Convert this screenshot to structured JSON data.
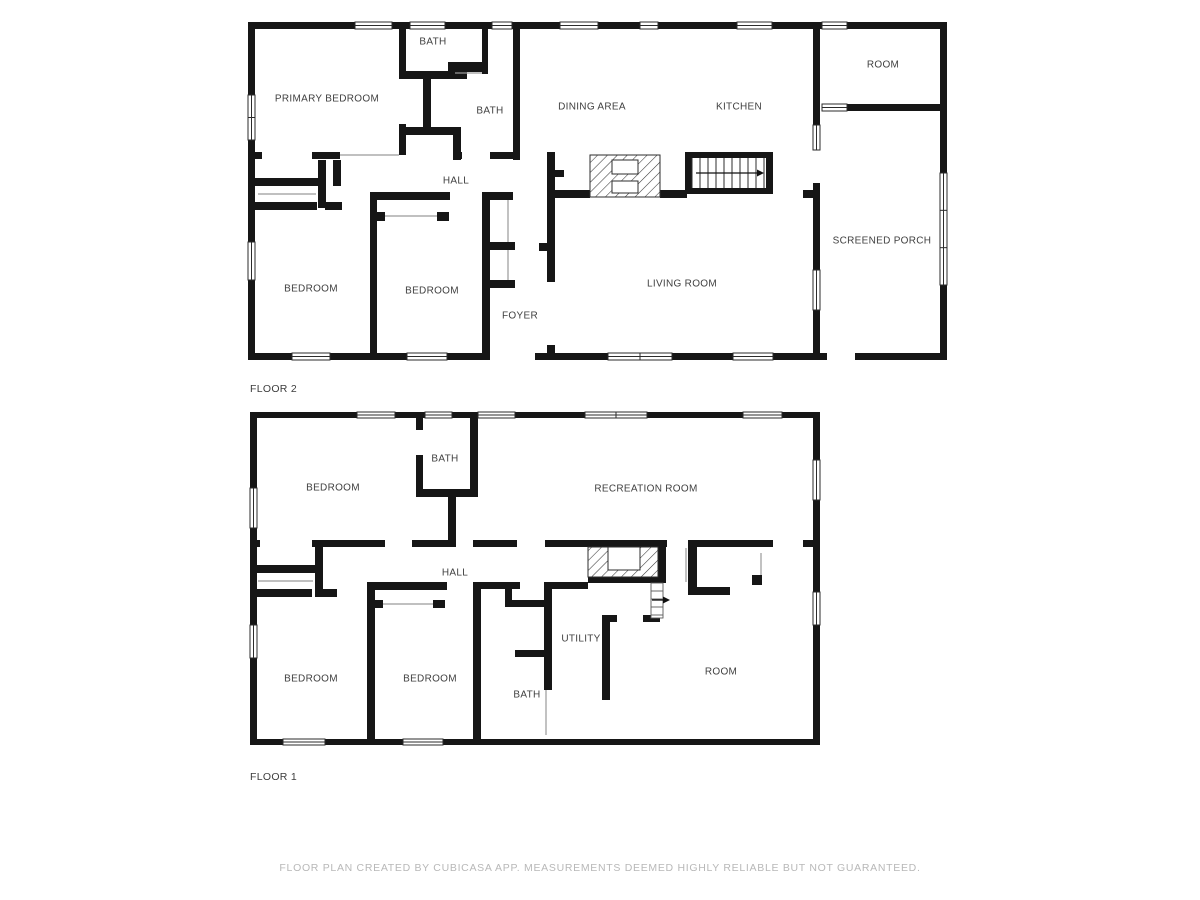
{
  "colors": {
    "wall": "#161616",
    "label": "#3f3f3f",
    "floor_label": "#3d3d3d",
    "thin": "#9a9a9a",
    "window_stroke": "#2b2b2b",
    "footer_text": "#b8b8b8",
    "background": "#ffffff"
  },
  "footer": {
    "disclaimer": "FLOOR PLAN CREATED BY CUBICASA APP. MEASUREMENTS DEEMED HIGHLY RELIABLE BUT NOT GUARANTEED."
  },
  "floors": [
    {
      "name": "FLOOR 2",
      "slug": "floor-2",
      "label_x": 250,
      "label_y": 392,
      "rooms": [
        {
          "text": "PRIMARY BEDROOM",
          "x": 327,
          "y": 98
        },
        {
          "text": "BATH",
          "x": 433,
          "y": 41
        },
        {
          "text": "BATH",
          "x": 490,
          "y": 110
        },
        {
          "text": "DINING AREA",
          "x": 592,
          "y": 106
        },
        {
          "text": "KITCHEN",
          "x": 739,
          "y": 106
        },
        {
          "text": "ROOM",
          "x": 883,
          "y": 64
        },
        {
          "text": "HALL",
          "x": 456,
          "y": 180
        },
        {
          "text": "SCREENED PORCH",
          "x": 882,
          "y": 240
        },
        {
          "text": "BEDROOM",
          "x": 311,
          "y": 288
        },
        {
          "text": "BEDROOM",
          "x": 432,
          "y": 290
        },
        {
          "text": "FOYER",
          "x": 520,
          "y": 315
        },
        {
          "text": "LIVING ROOM",
          "x": 682,
          "y": 283
        }
      ],
      "walls": [
        [
          248,
          22,
          574,
          7
        ],
        [
          847,
          22,
          93,
          7
        ],
        [
          248,
          22,
          7,
          338
        ],
        [
          248,
          353,
          242,
          7
        ],
        [
          535,
          353,
          292,
          7
        ],
        [
          855,
          353,
          92,
          7
        ],
        [
          813,
          22,
          7,
          103
        ],
        [
          813,
          183,
          7,
          87
        ],
        [
          813,
          310,
          7,
          50
        ],
        [
          940,
          22,
          7,
          338
        ],
        [
          847,
          104,
          93,
          7
        ],
        [
          399,
          22,
          7,
          52
        ],
        [
          399,
          124,
          7,
          31
        ],
        [
          399,
          71,
          68,
          8
        ],
        [
          423,
          79,
          8,
          50
        ],
        [
          403,
          127,
          58,
          8
        ],
        [
          453,
          129,
          8,
          31
        ],
        [
          482,
          22,
          6,
          52
        ],
        [
          448,
          62,
          40,
          10
        ],
        [
          513,
          29,
          7,
          131
        ],
        [
          248,
          152,
          14,
          7
        ],
        [
          312,
          152,
          28,
          7
        ],
        [
          453,
          152,
          9,
          7
        ],
        [
          490,
          152,
          30,
          7
        ],
        [
          250,
          178,
          70,
          8
        ],
        [
          318,
          160,
          8,
          48
        ],
        [
          333,
          160,
          8,
          26
        ],
        [
          248,
          202,
          69,
          8
        ],
        [
          325,
          202,
          17,
          8
        ],
        [
          370,
          192,
          7,
          161
        ],
        [
          370,
          192,
          80,
          8
        ],
        [
          375,
          212,
          10,
          9
        ],
        [
          437,
          212,
          12,
          9
        ],
        [
          482,
          192,
          8,
          161
        ],
        [
          482,
          192,
          31,
          8
        ],
        [
          488,
          242,
          27,
          8
        ],
        [
          488,
          280,
          27,
          8
        ],
        [
          547,
          152,
          8,
          130
        ],
        [
          547,
          345,
          8,
          15
        ],
        [
          555,
          170,
          9,
          7
        ],
        [
          539,
          243,
          8,
          8
        ],
        [
          553,
          190,
          37,
          8
        ],
        [
          660,
          190,
          27,
          8
        ],
        [
          803,
          190,
          14,
          8
        ],
        [
          685,
          152,
          88,
          6
        ],
        [
          685,
          188,
          88,
          6
        ],
        [
          685,
          152,
          7,
          42
        ],
        [
          766,
          152,
          7,
          42
        ]
      ],
      "windows": [
        [
          355,
          22,
          37,
          7,
          1
        ],
        [
          410,
          22,
          35,
          7,
          1
        ],
        [
          492,
          22,
          20,
          7,
          1
        ],
        [
          560,
          22,
          38,
          7,
          1
        ],
        [
          640,
          22,
          18,
          7,
          1
        ],
        [
          737,
          22,
          35,
          7,
          1
        ],
        [
          822,
          22,
          25,
          7,
          1
        ],
        [
          248,
          95,
          7,
          45,
          2
        ],
        [
          248,
          242,
          7,
          38,
          1
        ],
        [
          292,
          353,
          38,
          7,
          1
        ],
        [
          407,
          353,
          40,
          7,
          1
        ],
        [
          608,
          353,
          64,
          7,
          2
        ],
        [
          733,
          353,
          40,
          7,
          1
        ],
        [
          813,
          125,
          7,
          25,
          1
        ],
        [
          813,
          270,
          7,
          40,
          1
        ],
        [
          940,
          173,
          7,
          112,
          3
        ],
        [
          822,
          104,
          25,
          7,
          1
        ]
      ],
      "thin_lines": [
        [
          340,
          155,
          399,
          155
        ],
        [
          258,
          194,
          316,
          194
        ],
        [
          385,
          216,
          437,
          216
        ],
        [
          508,
          200,
          508,
          242
        ],
        [
          508,
          250,
          508,
          280
        ],
        [
          455,
          73,
          482,
          73
        ]
      ],
      "hatch_stairs": [
        {
          "x": 590,
          "y": 155,
          "w": 70,
          "h": 42,
          "holes": [
            [
              612,
              160,
              26,
              14
            ],
            [
              612,
              181,
              26,
              12
            ]
          ]
        }
      ],
      "tread_stairs": [
        {
          "x": 692,
          "y": 158,
          "w": 74,
          "h": 30,
          "dir": "h",
          "step": 8,
          "outline": false
        }
      ],
      "arrows": [
        {
          "x1": 696,
          "y1": 173,
          "x2": 757,
          "y2": 173
        }
      ]
    },
    {
      "name": "FLOOR 1",
      "slug": "floor-1",
      "label_x": 250,
      "label_y": 780,
      "rooms": [
        {
          "text": "BEDROOM",
          "x": 333,
          "y": 487
        },
        {
          "text": "BATH",
          "x": 445,
          "y": 458
        },
        {
          "text": "RECREATION ROOM",
          "x": 646,
          "y": 488
        },
        {
          "text": "HALL",
          "x": 455,
          "y": 572
        },
        {
          "text": "BEDROOM",
          "x": 311,
          "y": 678
        },
        {
          "text": "BEDROOM",
          "x": 430,
          "y": 678
        },
        {
          "text": "UTILITY",
          "x": 581,
          "y": 638
        },
        {
          "text": "BATH",
          "x": 527,
          "y": 694
        },
        {
          "text": "ROOM",
          "x": 721,
          "y": 671
        }
      ],
      "walls": [
        [
          250,
          412,
          567,
          6
        ],
        [
          250,
          412,
          7,
          333
        ],
        [
          250,
          739,
          567,
          6
        ],
        [
          813,
          412,
          7,
          333
        ],
        [
          416,
          412,
          7,
          18
        ],
        [
          416,
          455,
          7,
          42
        ],
        [
          416,
          489,
          61,
          8
        ],
        [
          470,
          412,
          8,
          85
        ],
        [
          448,
          492,
          8,
          55
        ],
        [
          250,
          540,
          10,
          7
        ],
        [
          312,
          540,
          73,
          7
        ],
        [
          412,
          540,
          36,
          7
        ],
        [
          473,
          540,
          44,
          7
        ],
        [
          545,
          540,
          122,
          7
        ],
        [
          697,
          540,
          76,
          7
        ],
        [
          803,
          540,
          14,
          7
        ],
        [
          588,
          577,
          70,
          6
        ],
        [
          658,
          540,
          8,
          43
        ],
        [
          643,
          615,
          17,
          7
        ],
        [
          688,
          540,
          9,
          55
        ],
        [
          688,
          587,
          42,
          8
        ],
        [
          752,
          575,
          10,
          10
        ],
        [
          505,
          582,
          15,
          7
        ],
        [
          505,
          582,
          7,
          25
        ],
        [
          512,
          600,
          32,
          7
        ],
        [
          473,
          582,
          32,
          7
        ],
        [
          544,
          582,
          44,
          7
        ],
        [
          544,
          582,
          8,
          108
        ],
        [
          515,
          650,
          29,
          7
        ],
        [
          602,
          615,
          15,
          7
        ],
        [
          602,
          615,
          8,
          85
        ],
        [
          250,
          565,
          65,
          8
        ],
        [
          315,
          540,
          8,
          57
        ],
        [
          250,
          589,
          62,
          8
        ],
        [
          322,
          589,
          15,
          8
        ],
        [
          367,
          582,
          8,
          161
        ],
        [
          367,
          582,
          80,
          8
        ],
        [
          473,
          582,
          8,
          161
        ],
        [
          373,
          600,
          10,
          8
        ],
        [
          433,
          600,
          12,
          8
        ]
      ],
      "windows": [
        [
          357,
          412,
          38,
          6,
          1
        ],
        [
          425,
          412,
          27,
          6,
          1
        ],
        [
          478,
          412,
          37,
          6,
          1
        ],
        [
          585,
          412,
          62,
          6,
          2
        ],
        [
          743,
          412,
          39,
          6,
          1
        ],
        [
          250,
          488,
          7,
          40,
          1
        ],
        [
          250,
          625,
          7,
          33,
          1
        ],
        [
          283,
          739,
          42,
          6,
          1
        ],
        [
          403,
          739,
          40,
          6,
          1
        ],
        [
          813,
          460,
          7,
          40,
          1
        ],
        [
          813,
          592,
          7,
          33,
          1
        ]
      ],
      "thin_lines": [
        [
          258,
          581,
          313,
          581
        ],
        [
          383,
          604,
          433,
          604
        ],
        [
          686,
          548,
          686,
          582
        ],
        [
          761,
          553,
          761,
          575
        ],
        [
          546,
          690,
          546,
          735
        ]
      ],
      "hatch_stairs": [
        {
          "x": 588,
          "y": 547,
          "w": 70,
          "h": 30,
          "holes": [
            [
              608,
              547,
              32,
              23
            ]
          ]
        }
      ],
      "tread_stairs": [
        {
          "x": 651,
          "y": 583,
          "w": 12,
          "h": 35,
          "dir": "v",
          "step": 8,
          "outline": true
        }
      ],
      "arrows": [
        {
          "x1": 652,
          "y1": 600,
          "x2": 663,
          "y2": 600
        }
      ]
    }
  ]
}
